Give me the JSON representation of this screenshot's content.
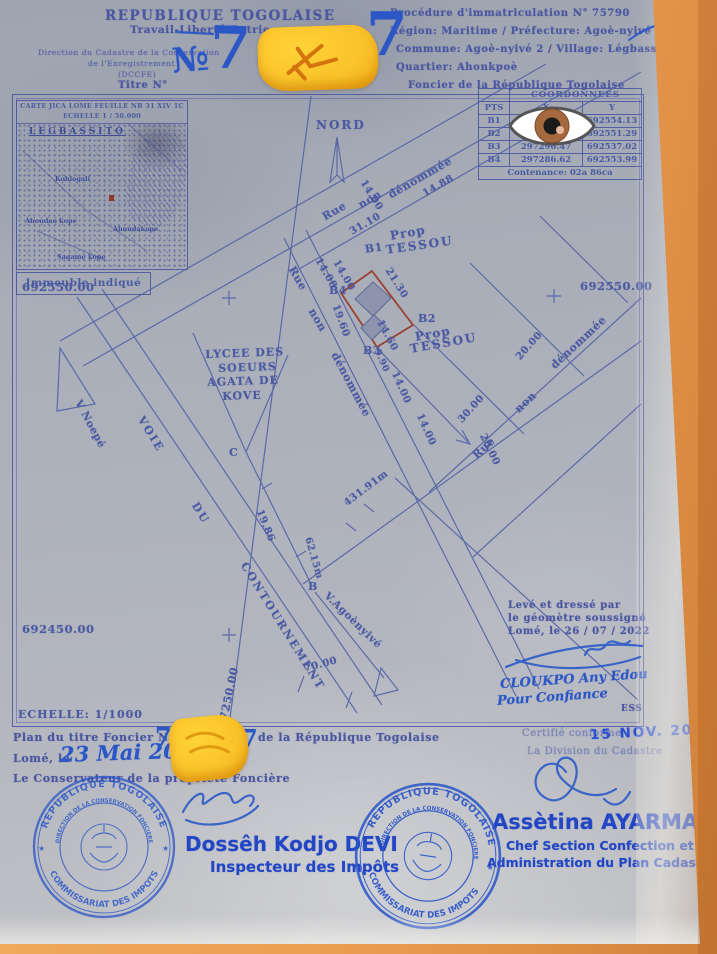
{
  "header": {
    "country": "REPUBLIQUE TOGOLAISE",
    "motto": "Travail-Liberté-Patrie",
    "dir1": "Direction du Cadastre de la Conservation",
    "dir2": "de l'Enregistrement",
    "dir3": "(DCCFE)",
    "titre": "Titre N°",
    "no_sign": "№",
    "seven_a": "7",
    "seven_b": "7",
    "procedure": "Procédure d'immatriculation N° 75790",
    "region": "Région: Maritime / Préfecture: Agoè-nyivé",
    "commune": "Commune: Agoè-nyivé 2 / Village: Légbassito /",
    "quartier": "Quartier: Ahonkpoè",
    "foncier": "Foncier de la République Togolaise"
  },
  "inset": {
    "t1": "CARTE JICA LOME FEUILLE NB 31 XIV 1C",
    "t2": "ECHELLE 1 / 50.000",
    "area": "LEGBASSITO",
    "p1": "Kohlogali",
    "p2": "Ahondao kope",
    "p3": "Ahondakope",
    "p4": "Sagamé kope",
    "caption": "Immeuble indiqué"
  },
  "table": {
    "title": "COORDONNEES",
    "c1": "PTS",
    "c2": "X",
    "c3": "Y",
    "rows": [
      [
        "B1",
        "297256.14",
        "692554.13"
      ],
      [
        "B2",
        "297306.25",
        "692551.29"
      ],
      [
        "B3",
        "297296.47",
        "692537.02"
      ],
      [
        "B4",
        "297286.62",
        "692553.99"
      ]
    ],
    "contenance": "Contenance: 02a 86ca"
  },
  "map": {
    "nord": "NORD",
    "rue": "Rue",
    "non": "non",
    "denommee": "dénommée",
    "m14_00": "14.00",
    "m14_88": "14.88",
    "m31_10": "31.10",
    "m14_08": "14.08",
    "m21_30": "21.30",
    "m19_60": "19.60",
    "m14_60": "14.60",
    "m9_90": "9.90",
    "m19_86": "19.86",
    "m30_00": "30.00",
    "m20_00": "20.00",
    "m70_00": "70.00",
    "m431": "431.91m",
    "m62": "62.15m",
    "prop": "Prop",
    "tessou": "TESSOU",
    "b1": "B1",
    "b2": "B2",
    "b3": "B3",
    "b4": "B4",
    "ptB": "B",
    "ptC": "C",
    "lycee1": "LYCEE DES",
    "lycee2": "SOEURS",
    "lycee3": "AGATA DE",
    "lycee4": "KOVE",
    "voie": "VOIE",
    "du": "DU",
    "contournement": "CONTOURNEMENT",
    "vnoepe": "V Noepé",
    "vagoe": "V.Agoènyivé",
    "g_692550": "692550.00",
    "g_692450": "692450.00",
    "g_297250": "297250.00",
    "echelle": "ECHELLE: 1/1000"
  },
  "survey": {
    "l1": "Levé et dressé par",
    "l2": "le géomètre soussigné",
    "l3": "Lomé, le 26 / 07 / 2022",
    "sig": "CLOUKPO Any Edou",
    "sig2": "Pour Confiance",
    "ess": "ESS"
  },
  "footer": {
    "plan1": "Plan du titre Foncier N°",
    "seven_c": "7",
    "seven_d": "7",
    "plan2": "de la République Togolaise",
    "lome": "Lomé, le",
    "date_hand": "23 Mai 20",
    "conservateur": "Le Conservateur de la propriété Foncière",
    "certifie": "Certifié conforme",
    "date_stamp": "15 NOV. 2023",
    "division": "La Division du Cadastre",
    "name1": "Dossêh Kodjo DEVI",
    "role1": "Inspecteur des Impôts",
    "name2": "Assètina AYARMA",
    "role2a": "Chef Section Confection et",
    "role2b": "Administration du Plan Cadastral",
    "stamp_top": "REPUBLIQUE TOGOLAISE",
    "stamp_bottom": "COMMISSARIAT DES IMPOTS",
    "stamp_inner": "DIRECTION DE LA CONSERVATION FONCIERE"
  }
}
